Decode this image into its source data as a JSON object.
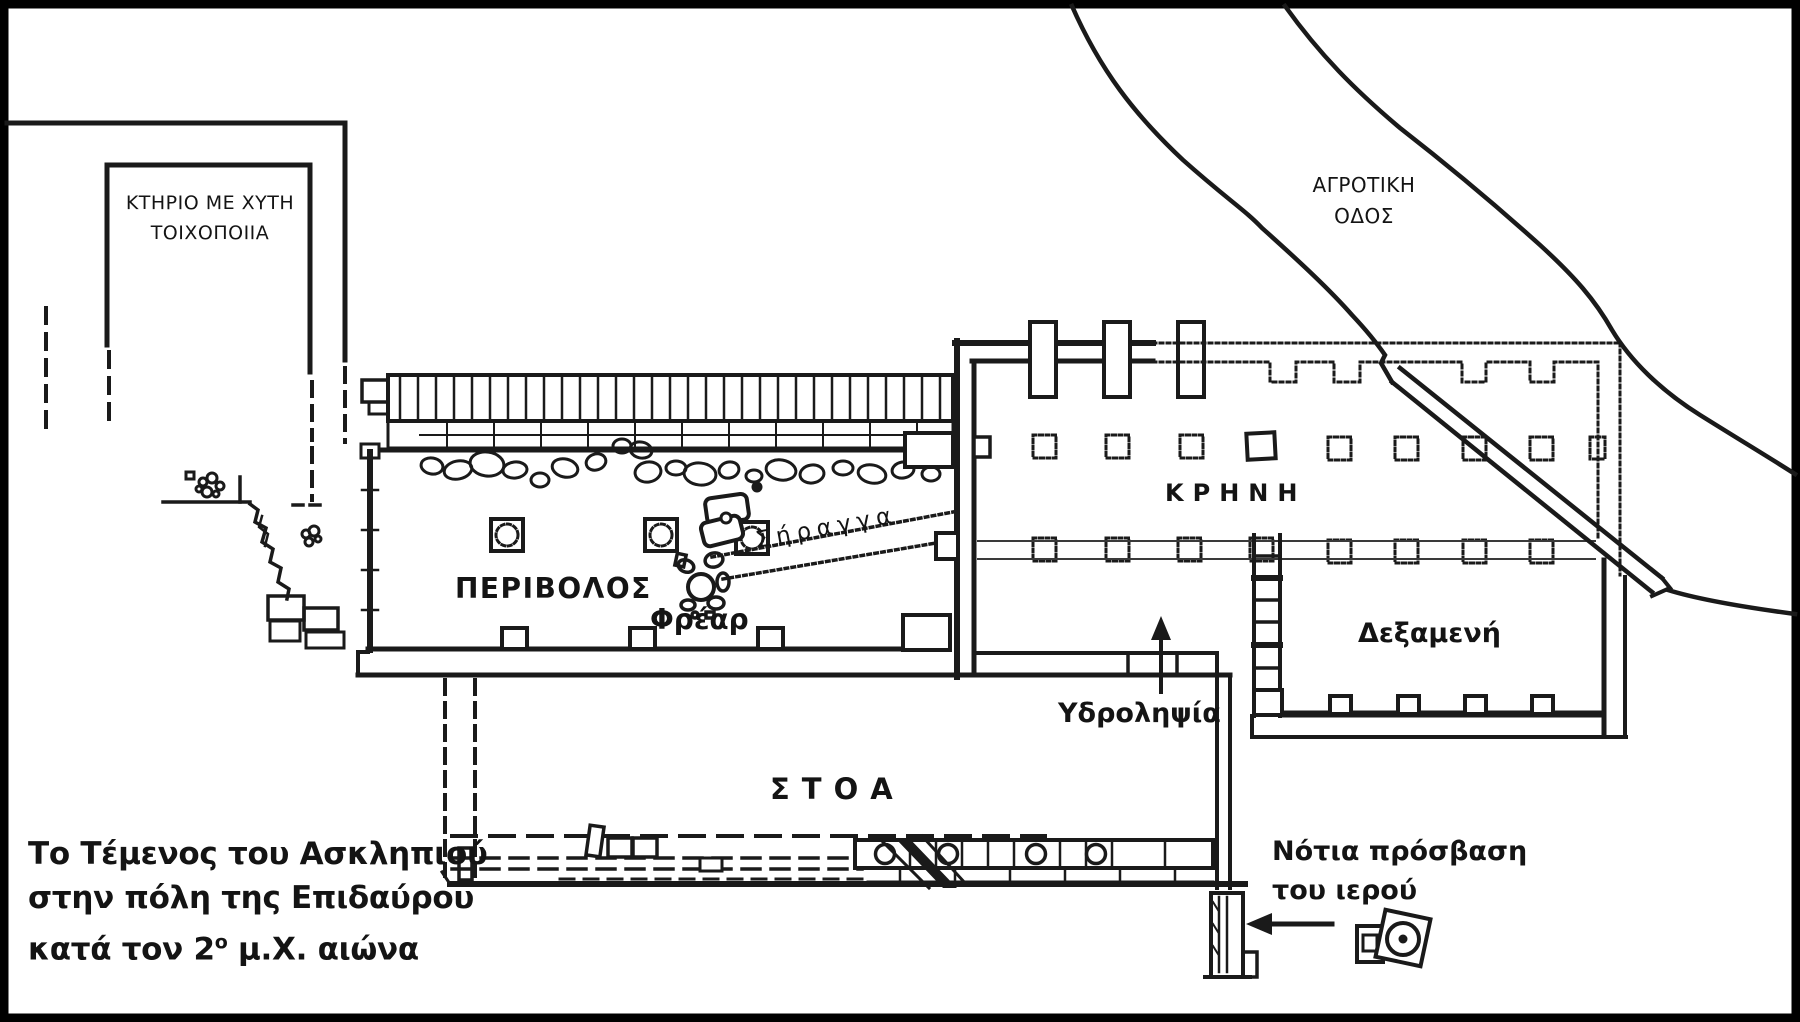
{
  "canvas": {
    "background": "#ffffff",
    "ink": "#1a1a1a"
  },
  "title": {
    "line1": "Το Τέμενος του Ασκληπιού",
    "line2": "στην πόλη της Επιδαύρου",
    "line3a": "κατά τον 2",
    "line3sup": "ο",
    "line3b": " μ.Χ. αιώνα"
  },
  "labels": {
    "building": {
      "line1": "ΚΤΗΡΙΟ ΜΕ ΧΥΤΗ",
      "line2": "ΤΟΙΧΟΠΟΙΙΑ"
    },
    "road": {
      "line1": "ΑΓΡΟΤΙΚΗ",
      "line2": "ΟΔΟΣ"
    },
    "peribolos": "ΠΕΡΙΒΟΛΟΣ",
    "frear": "Φρέαρ",
    "siranga": "Σήραγγα",
    "krini": "ΚΡΗΝΗ",
    "dexameni": "Δεξαμενή",
    "ydrolipsia": "Υδροληψία",
    "stoa": "ΣΤΟΑ",
    "notia": {
      "line1": "Νότια πρόσβαση",
      "line2": "του ιερού"
    }
  }
}
